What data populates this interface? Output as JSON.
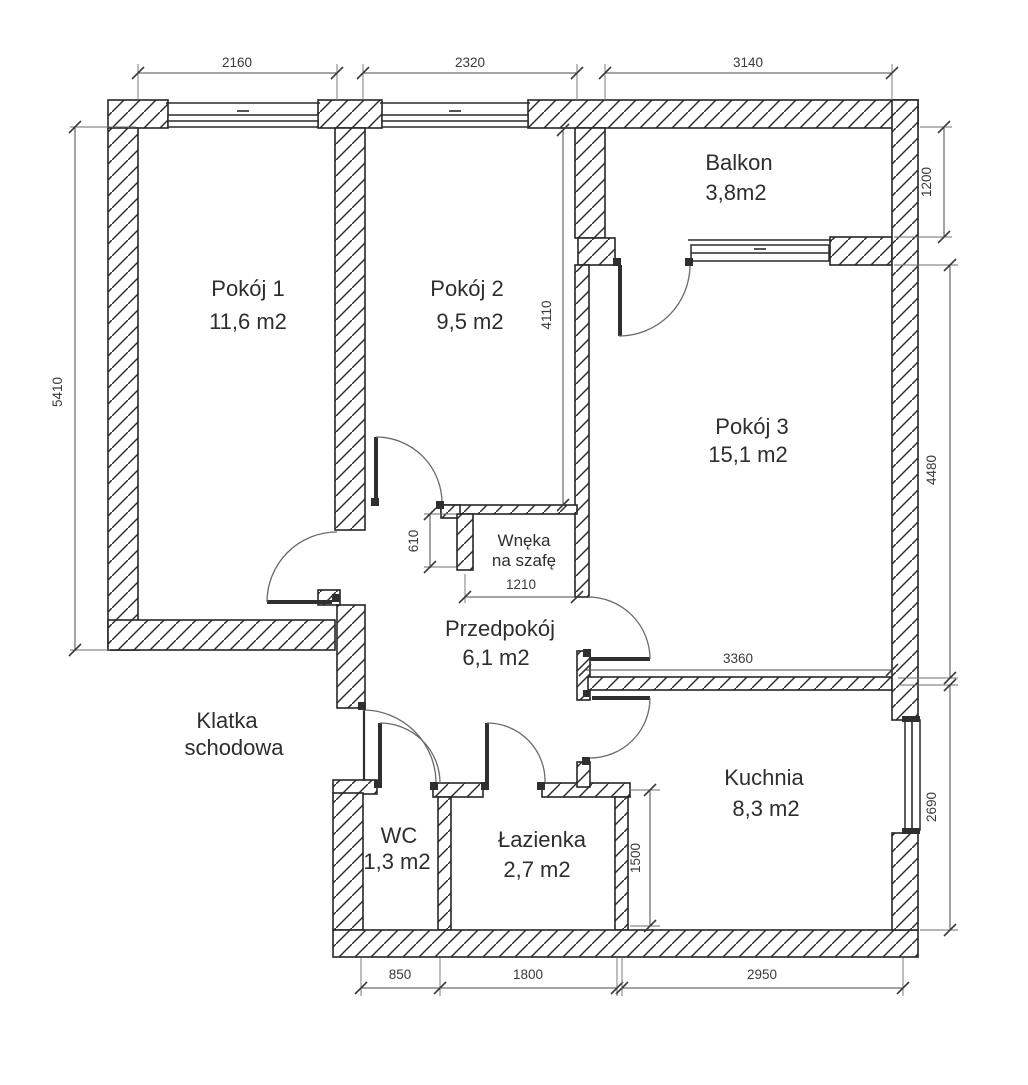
{
  "drawing_type": "apartment floor plan",
  "rooms": {
    "pokoj1": {
      "name": "Pokój 1",
      "area": "11,6 m2"
    },
    "pokoj2": {
      "name": "Pokój 2",
      "area": "9,5 m2"
    },
    "pokoj3": {
      "name": "Pokój 3",
      "area": "15,1 m2"
    },
    "balkon": {
      "name": "Balkon",
      "area": "3,8m2"
    },
    "przedpokoj": {
      "name": "Przedpokój",
      "area": "6,1 m2"
    },
    "kuchnia": {
      "name": "Kuchnia",
      "area": "8,3 m2"
    },
    "lazienka": {
      "name": "Łazienka",
      "area": "2,7 m2"
    },
    "wc": {
      "name": "WC",
      "area": "1,3 m2"
    },
    "wneka": {
      "line1": "Wnęka",
      "line2": "na szafę"
    },
    "klatka": {
      "line1": "Klatka",
      "line2": "schodowa"
    }
  },
  "dims": {
    "top1": "2160",
    "top2": "2320",
    "top3": "3140",
    "left1": "5410",
    "right1": "1200",
    "right2": "4480",
    "right3": "2690",
    "pokoj2_height": "4110",
    "wneka_depth": "610",
    "wneka_width": "1210",
    "kuchnia_wall": "3360",
    "lazienka_height": "1500",
    "bottom1": "850",
    "bottom2": "1800",
    "bottom3": "2950"
  },
  "colors": {
    "background": "#ffffff",
    "wall_line": "#262626",
    "dimension_text": "#3a3a3a",
    "room_text": "#2e2e2e"
  }
}
